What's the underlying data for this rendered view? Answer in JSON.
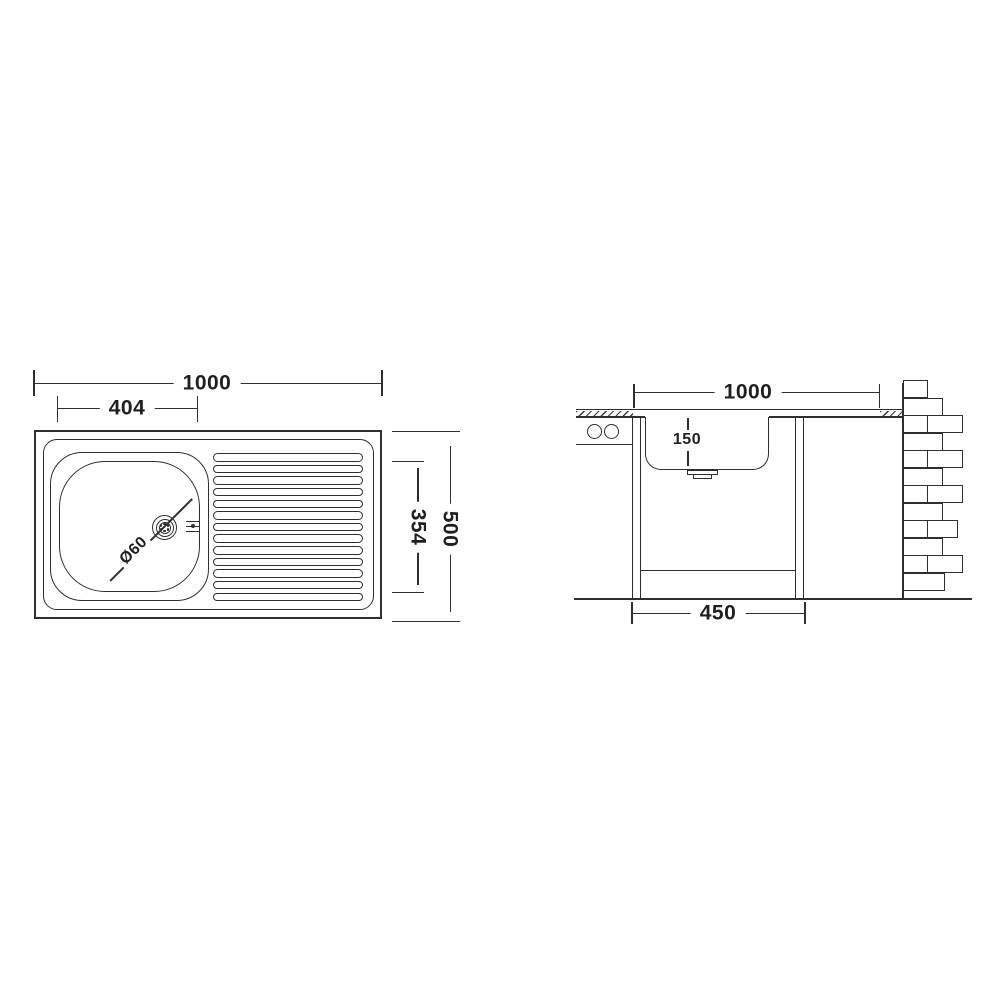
{
  "palette": {
    "line": "#2f2f2f",
    "text": "#1f1f1f",
    "background": "#ffffff"
  },
  "top_view": {
    "title": "sink-top-view",
    "dim_overall_width": "1000",
    "dim_bowl_width": "404",
    "dim_overall_depth": "500",
    "dim_bowl_depth": "354",
    "drain_label": "Ø60",
    "ribs_count": 13,
    "drain_holes": 6
  },
  "section_view": {
    "title": "sink-section-view",
    "dim_width": "1000",
    "dim_bowl_depth": "150",
    "dim_base_width": "450",
    "bricks": [
      {
        "x": 903,
        "y": 380,
        "w": 25,
        "h": 18
      },
      {
        "x": 903,
        "y": 398,
        "w": 40,
        "h": 18
      },
      {
        "x": 903,
        "y": 415,
        "w": 25,
        "h": 18
      },
      {
        "x": 927,
        "y": 415,
        "w": 36,
        "h": 18
      },
      {
        "x": 903,
        "y": 433,
        "w": 40,
        "h": 18
      },
      {
        "x": 903,
        "y": 450,
        "w": 25,
        "h": 18
      },
      {
        "x": 927,
        "y": 450,
        "w": 36,
        "h": 18
      },
      {
        "x": 903,
        "y": 468,
        "w": 40,
        "h": 18
      },
      {
        "x": 903,
        "y": 485,
        "w": 25,
        "h": 18
      },
      {
        "x": 927,
        "y": 485,
        "w": 36,
        "h": 18
      },
      {
        "x": 903,
        "y": 503,
        "w": 40,
        "h": 18
      },
      {
        "x": 903,
        "y": 520,
        "w": 25,
        "h": 18
      },
      {
        "x": 927,
        "y": 520,
        "w": 31,
        "h": 18
      },
      {
        "x": 903,
        "y": 538,
        "w": 40,
        "h": 18
      },
      {
        "x": 903,
        "y": 555,
        "w": 25,
        "h": 18
      },
      {
        "x": 927,
        "y": 555,
        "w": 36,
        "h": 18
      },
      {
        "x": 903,
        "y": 573,
        "w": 42,
        "h": 18
      }
    ]
  }
}
